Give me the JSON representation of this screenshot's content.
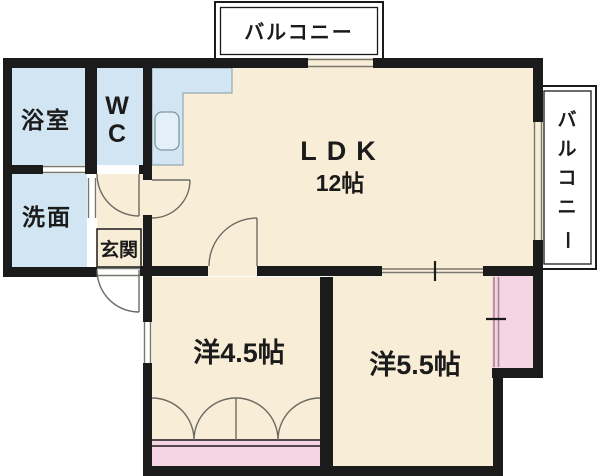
{
  "plan": {
    "type": "apartment-floor-plan",
    "rooms": {
      "ldk": {
        "name": "ＬＤＫ",
        "display": "LDK",
        "size": "12帖"
      },
      "bedroom_small": {
        "name": "洋4.5帖"
      },
      "bedroom_large": {
        "name": "洋5.5帖"
      },
      "bathroom": {
        "name": "浴室"
      },
      "toilet": {
        "line1": "W",
        "line2": "C"
      },
      "washroom": {
        "name": "洗面"
      },
      "entrance": {
        "name": "玄関"
      },
      "balcony_top": {
        "name": "バルコニー"
      },
      "balcony_right": {
        "name": "バルコニー",
        "chars": [
          "バ",
          "ル",
          "コ",
          "ニ",
          "ー"
        ]
      }
    },
    "colors": {
      "wall": "#1b1b1b",
      "floor": "#f8edd6",
      "wet_area": "#d2e5f2",
      "closet": "#f5d4e3",
      "closet_door_line": "#a8868e",
      "symbol_line": "#6b6b63",
      "background": "#ffffff"
    }
  }
}
